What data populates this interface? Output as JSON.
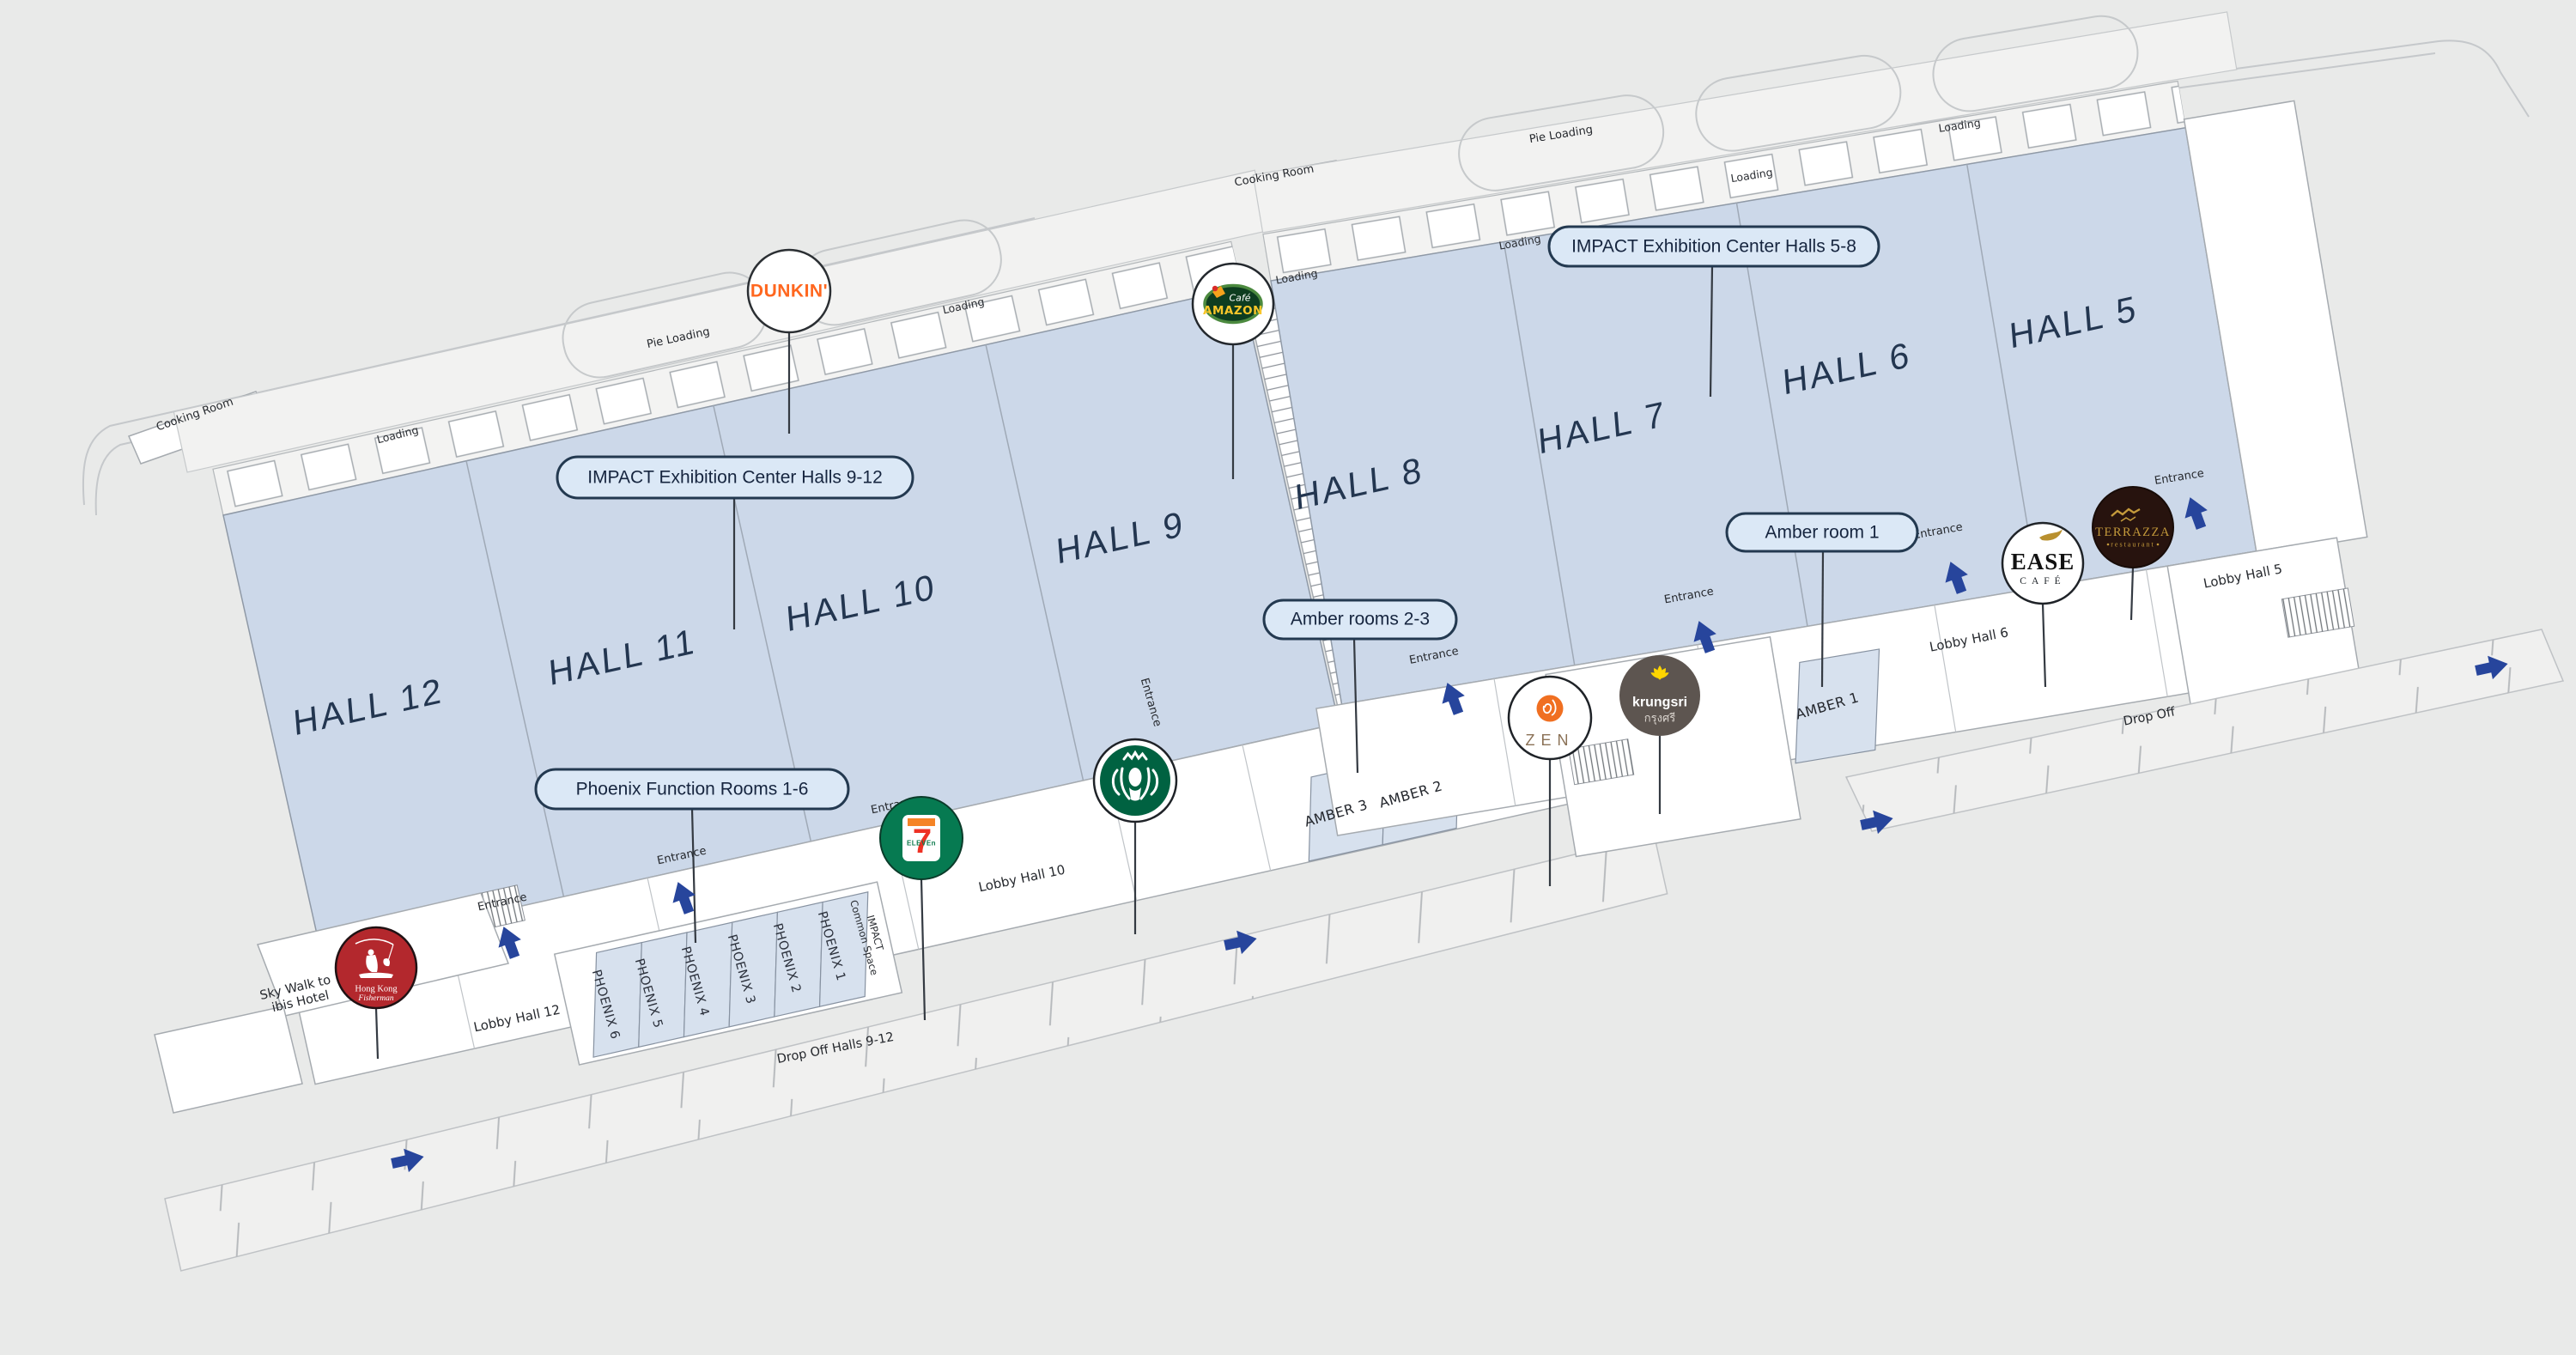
{
  "palette": {
    "background": "#e9eae9",
    "building_fill": "#ffffff",
    "outline_gray": "#a6abb0",
    "hall_fill": "#ccd8e9",
    "hall_text": "#233650",
    "callout_fill": "#dbe8f6",
    "callout_border": "#233950",
    "arrow_blue": "#27459c",
    "dunkin_orange": "#ff671f",
    "starbucks_green": "#006241",
    "seven_eleven_green": "#067a51",
    "krungsri_brown": "#5d5550",
    "krungsri_yellow": "#ffd600",
    "terrazza_brown": "#27130e",
    "terrazza_gold": "#c49a3b",
    "hong_kong_red": "#b3282d",
    "zen_orange": "#f06f21"
  },
  "halls": [
    {
      "label": "HALL 12"
    },
    {
      "label": "HALL 11"
    },
    {
      "label": "HALL 10"
    },
    {
      "label": "HALL 9"
    },
    {
      "label": "HALL 8"
    },
    {
      "label": "HALL 7"
    },
    {
      "label": "HALL 6"
    },
    {
      "label": "HALL 5"
    }
  ],
  "callouts": [
    {
      "id": "halls-9-12",
      "label": "IMPACT Exhibition Center Halls 9-12"
    },
    {
      "id": "halls-5-8",
      "label": "IMPACT Exhibition Center Halls 5-8"
    },
    {
      "id": "phoenix-rooms",
      "label": "Phoenix Function Rooms 1-6"
    },
    {
      "id": "amber-rooms-2-3",
      "label": "Amber rooms 2-3"
    },
    {
      "id": "amber-room-1",
      "label": "Amber room 1"
    }
  ],
  "rooms": {
    "phoenix": [
      "PHOENIX 6",
      "PHOENIX 5",
      "PHOENIX 4",
      "PHOENIX 3",
      "PHOENIX 2",
      "PHOENIX 1"
    ],
    "amber": [
      "AMBER 3",
      "AMBER 2",
      "AMBER 1"
    ],
    "impact_common_space": {
      "line1": "IMPACT",
      "line2": "Common Space"
    }
  },
  "labels": {
    "cooking_room": "Cooking Room",
    "pie_loading": "Pie Loading",
    "loading": "Loading",
    "entrance": "Entrance",
    "lobby_hall_12": "Lobby Hall 12",
    "lobby_hall_10": "Lobby Hall 10",
    "lobby_hall_6": "Lobby Hall 6",
    "lobby_hall_5": "Lobby Hall 5",
    "drop_off_halls_9_12": "Drop Off Halls 9-12",
    "drop_off": "Drop Off",
    "sky_walk": {
      "line1": "Sky Walk to",
      "line2": "ibis Hotel"
    }
  },
  "logos": {
    "dunkin": {
      "label": "DUNKIN'"
    },
    "cafe_amazon": {
      "top": "Café",
      "main": "AMAZON"
    },
    "seven_eleven": {
      "digit": "7",
      "word": "ELEVEn"
    },
    "starbucks": {
      "icon": "starbucks-siren"
    },
    "zen": {
      "label": "ZEN"
    },
    "krungsri": {
      "label": "krungsri",
      "thai": "กรุงศรี"
    },
    "ease_cafe": {
      "main": "EASE",
      "sub": "CAFÉ"
    },
    "terrazza": {
      "main": "TERRAZZA",
      "sub": "restaurant"
    },
    "hong_kong_fisherman": {
      "line1": "Hong Kong",
      "line2": "Fisherman"
    }
  }
}
